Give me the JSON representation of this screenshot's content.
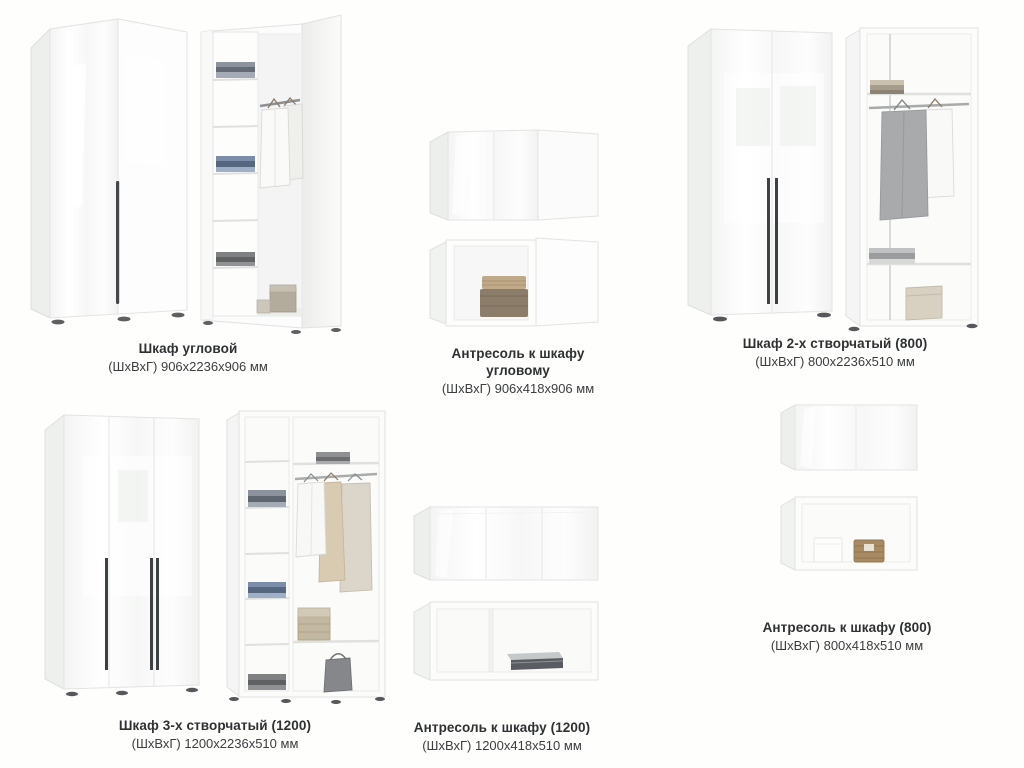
{
  "page": {
    "background": "#fefefd",
    "text_color": "#2e3032"
  },
  "palette": {
    "furniture_white": "#fcfdfc",
    "furniture_side": "#edefed",
    "handle_dark": "#3e4144",
    "interior_gray": "#f4f5f4",
    "rail_silver": "#a9abab",
    "basket_beige": "#c3b8a2",
    "wicker_brown": "#a88b63",
    "jeans_blue": "#55677f"
  },
  "products": [
    {
      "id": "corner-wardrobe",
      "name": "Шкаф угловой",
      "dims": "(ШхВхГ) 906х2236х906 мм"
    },
    {
      "id": "mezzanine-corner",
      "name": "Антресоль к шкафу угловому",
      "dims": "(ШхВхГ) 906х418х906 мм"
    },
    {
      "id": "wardrobe-2-door-800",
      "name": "Шкаф 2-х створчатый (800)",
      "dims": "(ШхВхГ) 800х2236х510 мм"
    },
    {
      "id": "wardrobe-3-door-1200",
      "name": "Шкаф 3-х створчатый (1200)",
      "dims": "(ШхВхГ) 1200х2236х510 мм"
    },
    {
      "id": "mezzanine-1200",
      "name": "Антресоль к шкафу (1200)",
      "dims": "(ШхВхГ) 1200х418х510 мм"
    },
    {
      "id": "mezzanine-800",
      "name": "Антресоль к шкафу (800)",
      "dims": "(ШхВхГ) 800х418х510 мм"
    }
  ]
}
